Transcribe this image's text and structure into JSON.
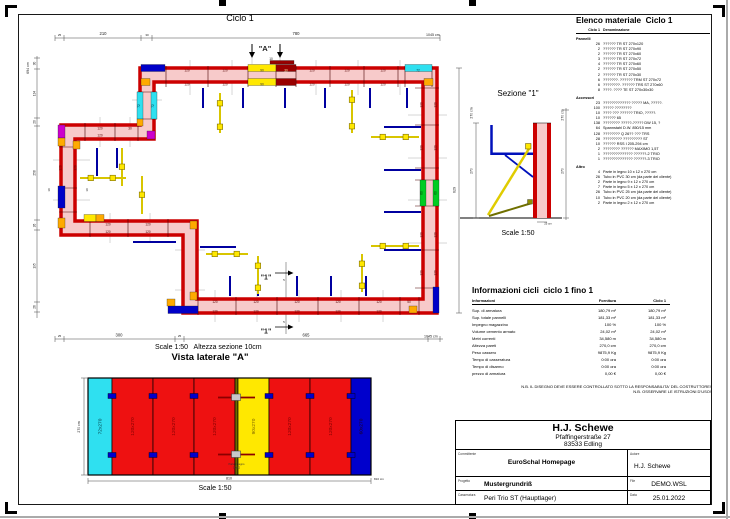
{
  "page": {
    "ciclo_title": "Ciclo 1"
  },
  "plan": {
    "scale_note": "Scale 1:50   Altezza sezione 10cm",
    "labels": [
      {
        "x": 59.5,
        "y": 36,
        "t": "25",
        "s": 3
      },
      {
        "x": 103,
        "y": 35,
        "t": "210"
      },
      {
        "x": 147,
        "y": 36,
        "t": "30",
        "s": 3
      },
      {
        "x": 296,
        "y": 35,
        "t": "780"
      },
      {
        "x": 426,
        "y": 36,
        "t": "1045 cm",
        "s": 3.6,
        "a": "start"
      },
      {
        "x": 29,
        "y": 68,
        "t": "694 cm",
        "r": -90,
        "s": 3.6
      },
      {
        "x": 35.5,
        "y": 63.5,
        "t": "30",
        "r": -90,
        "s": 3.2
      },
      {
        "x": 35.5,
        "y": 93.5,
        "t": "134",
        "r": -90,
        "s": 3.2
      },
      {
        "x": 35.5,
        "y": 122,
        "t": "20",
        "r": -90,
        "s": 3.2
      },
      {
        "x": 35.5,
        "y": 173,
        "t": "258",
        "r": -90,
        "s": 3.2
      },
      {
        "x": 35.5,
        "y": 225.5,
        "t": "26",
        "r": -90,
        "s": 3.2
      },
      {
        "x": 35.5,
        "y": 266,
        "t": "195",
        "r": -90,
        "s": 3.2
      },
      {
        "x": 35.5,
        "y": 307,
        "t": "26",
        "r": -90,
        "s": 3.2
      },
      {
        "x": 59.5,
        "y": 337,
        "t": "25",
        "s": 3
      },
      {
        "x": 119,
        "y": 336.5,
        "t": "300"
      },
      {
        "x": 179.5,
        "y": 337,
        "t": "25",
        "s": 3
      },
      {
        "x": 306,
        "y": 336.5,
        "t": "665"
      },
      {
        "x": 424,
        "y": 337.5,
        "t": "1045 cm",
        "s": 3.6,
        "a": "start"
      },
      {
        "x": 455.5,
        "y": 190,
        "t": "629",
        "r": -90,
        "s": 3.6
      },
      {
        "x": 271,
        "y": 60,
        "t": "10",
        "s": 3.2
      },
      {
        "x": 284,
        "y": 281,
        "t": "5",
        "s": 3
      },
      {
        "x": 284,
        "y": 323,
        "t": "5",
        "s": 3
      },
      {
        "x": 50,
        "y": 190,
        "t": "10",
        "r": -90,
        "s": 3
      },
      {
        "x": 88,
        "y": 190,
        "t": "10",
        "r": -90,
        "s": 3
      },
      {
        "x": 265,
        "y": 51,
        "t": "\"A\"",
        "s": 7.5,
        "b": 1
      },
      {
        "x": 266,
        "y": 279.5,
        "t": "\"1\"",
        "s": 7,
        "b": 1
      },
      {
        "x": 266,
        "y": 333.5,
        "t": "\"1\"",
        "s": 7,
        "b": 1
      },
      {
        "x": 187,
        "y": 71.3,
        "t": "120",
        "s": 3.2,
        "c": "#550000"
      },
      {
        "x": 225,
        "y": 71.3,
        "t": "120",
        "s": 3.2,
        "c": "#550000"
      },
      {
        "x": 262,
        "y": 71.3,
        "t": "90",
        "s": 3.2,
        "c": "#333333"
      },
      {
        "x": 286,
        "y": 71.3,
        "t": "30",
        "s": 3.2,
        "c": "#ffeeaa"
      },
      {
        "x": 312,
        "y": 71.3,
        "t": "120",
        "s": 3.2,
        "c": "#550000"
      },
      {
        "x": 347,
        "y": 71.3,
        "t": "120",
        "s": 3.2,
        "c": "#550000"
      },
      {
        "x": 383,
        "y": 71.3,
        "t": "120",
        "s": 3.2,
        "c": "#550000"
      },
      {
        "x": 418,
        "y": 71.3,
        "t": "72",
        "s": 3.2,
        "c": "#003344"
      },
      {
        "x": 187,
        "y": 85.3,
        "t": "120",
        "s": 3.2,
        "c": "#550000"
      },
      {
        "x": 225,
        "y": 85.3,
        "t": "120",
        "s": 3.2,
        "c": "#550000"
      },
      {
        "x": 262,
        "y": 85.3,
        "t": "90",
        "s": 3.2,
        "c": "#333333"
      },
      {
        "x": 312,
        "y": 85.3,
        "t": "120",
        "s": 3.2,
        "c": "#550000"
      },
      {
        "x": 347,
        "y": 85.3,
        "t": "120",
        "s": 3.2,
        "c": "#550000"
      },
      {
        "x": 383,
        "y": 85.3,
        "t": "120",
        "s": 3.2,
        "c": "#550000"
      },
      {
        "x": 436.5,
        "y": 105,
        "t": "120",
        "r": -90,
        "s": 3.2,
        "c": "#550000"
      },
      {
        "x": 436.5,
        "y": 148,
        "t": "120",
        "r": -90,
        "s": 3.2,
        "c": "#550000"
      },
      {
        "x": 436.5,
        "y": 193,
        "t": "60",
        "r": -90,
        "s": 3.2,
        "c": "#003300"
      },
      {
        "x": 436.5,
        "y": 235,
        "t": "120",
        "r": -90,
        "s": 3.2,
        "c": "#550000"
      },
      {
        "x": 436.5,
        "y": 273,
        "t": "120",
        "r": -90,
        "s": 3.2,
        "c": "#550000"
      },
      {
        "x": 422.5,
        "y": 105,
        "t": "120",
        "r": -90,
        "s": 3.2,
        "c": "#550000"
      },
      {
        "x": 422.5,
        "y": 148,
        "t": "120",
        "r": -90,
        "s": 3.2,
        "c": "#550000"
      },
      {
        "x": 422.5,
        "y": 193,
        "t": "60",
        "r": -90,
        "s": 3.2,
        "c": "#003300"
      },
      {
        "x": 422.5,
        "y": 235,
        "t": "120",
        "r": -90,
        "s": 3.2,
        "c": "#550000"
      },
      {
        "x": 422.5,
        "y": 273,
        "t": "120",
        "r": -90,
        "s": 3.2,
        "c": "#550000"
      },
      {
        "x": 215,
        "y": 302.8,
        "t": "120",
        "s": 3.2,
        "c": "#550000"
      },
      {
        "x": 256,
        "y": 302.8,
        "t": "120",
        "s": 3.2,
        "c": "#550000"
      },
      {
        "x": 297,
        "y": 302.8,
        "t": "120",
        "s": 3.2,
        "c": "#550000"
      },
      {
        "x": 338,
        "y": 302.8,
        "t": "120",
        "s": 3.2,
        "c": "#550000"
      },
      {
        "x": 379,
        "y": 302.8,
        "t": "120",
        "s": 3.2,
        "c": "#550000"
      },
      {
        "x": 409,
        "y": 302.8,
        "t": "50",
        "s": 3.2,
        "c": "#550000"
      },
      {
        "x": 215,
        "y": 312.3,
        "t": "120",
        "s": 3.2,
        "c": "#550000"
      },
      {
        "x": 256,
        "y": 312.3,
        "t": "120",
        "s": 3.2,
        "c": "#550000"
      },
      {
        "x": 297,
        "y": 312.3,
        "t": "120",
        "s": 3.2,
        "c": "#550000"
      },
      {
        "x": 338,
        "y": 312.3,
        "t": "120",
        "s": 3.2,
        "c": "#550000"
      },
      {
        "x": 379,
        "y": 312.3,
        "t": "120",
        "s": 3.2,
        "c": "#550000"
      },
      {
        "x": 108,
        "y": 225.3,
        "t": "120",
        "s": 3.2,
        "c": "#550000"
      },
      {
        "x": 148,
        "y": 225.3,
        "t": "120",
        "s": 3.2,
        "c": "#550000"
      },
      {
        "x": 108,
        "y": 232.8,
        "t": "120",
        "s": 3.2,
        "c": "#550000"
      },
      {
        "x": 148,
        "y": 232.8,
        "t": "120",
        "s": 3.2,
        "c": "#550000"
      },
      {
        "x": 100,
        "y": 129.3,
        "t": "120",
        "s": 3.2,
        "c": "#550000"
      },
      {
        "x": 130,
        "y": 129.3,
        "t": "30",
        "s": 3.2,
        "c": "#550000"
      },
      {
        "x": 100,
        "y": 136.3,
        "t": "120",
        "s": 3.2,
        "c": "#550000"
      },
      {
        "x": 61.5,
        "y": 168,
        "t": "120",
        "r": -90,
        "s": 3.2,
        "c": "#550000"
      },
      {
        "x": 76.5,
        "y": 168,
        "t": "120",
        "r": -90,
        "s": 3.2,
        "c": "#550000"
      },
      {
        "x": 140,
        "y": 106,
        "t": "72",
        "r": -90,
        "s": 3.2,
        "c": "#003344"
      },
      {
        "x": 154,
        "y": 106,
        "t": "72",
        "r": -90,
        "s": 3.2,
        "c": "#003344"
      }
    ]
  },
  "sezione": {
    "title": "Sezione \"1\"",
    "scale": "Scale 1:50",
    "labels": [
      {
        "x": 472.5,
        "y": 113,
        "t": "270 cm",
        "r": -90,
        "s": 3.4
      },
      {
        "x": 472.5,
        "y": 171,
        "t": "270",
        "r": -90,
        "s": 3.4
      },
      {
        "x": 563.5,
        "y": 115,
        "t": "270 cm",
        "r": -90,
        "s": 3.4
      },
      {
        "x": 563.5,
        "y": 171,
        "t": "270",
        "r": -90,
        "s": 3.4
      },
      {
        "x": 548,
        "y": 224.5,
        "t": "25 cm",
        "s": 2.8
      }
    ]
  },
  "vista": {
    "title": "Vista laterale \"A\"",
    "scale": "Scale 1:50",
    "panels": [
      {
        "w": 24,
        "color": "#2FE0F0",
        "label": "72x270",
        "lc": "#00333a"
      },
      {
        "w": 41,
        "color": "#EE1111",
        "label": "120x270",
        "lc": "#7a0000"
      },
      {
        "w": 41,
        "color": "#EE1111",
        "label": "120x270",
        "lc": "#7a0000"
      },
      {
        "w": 41,
        "color": "#EE1111",
        "label": "120x270",
        "lc": "#7a0000"
      },
      {
        "w": 3,
        "color": "#6B6B00",
        "label": "",
        "lc": ""
      },
      {
        "w": 31,
        "color": "#FFE800",
        "label": "90x270",
        "lc": "#7a6000"
      },
      {
        "w": 41,
        "color": "#EE1111",
        "label": "120x270",
        "lc": "#7a0000"
      },
      {
        "w": 41,
        "color": "#EE1111",
        "label": "120x270",
        "lc": "#7a0000"
      },
      {
        "w": 20,
        "color": "#0000CC",
        "label": "60x270",
        "lc": "#220011"
      }
    ],
    "labels": [
      {
        "x": 80,
        "y": 427,
        "t": "270 cm",
        "r": -90,
        "s": 3.4
      },
      {
        "x": 229,
        "y": 479.5,
        "t": "810",
        "s": 3.6
      },
      {
        "x": 374,
        "y": 480,
        "t": "810 cm",
        "s": 3,
        "a": "start"
      },
      {
        "x": 236.5,
        "y": 465,
        "t": "Parte in legno",
        "s": 2.6,
        "c": "#333333"
      },
      {
        "x": 236.5,
        "y": 468.5,
        "t": "10x12",
        "s": 2.6,
        "c": "#333333"
      }
    ]
  },
  "material_list": {
    "title": "Elenco materiale  Ciclo 1",
    "col_qty": "Ciclo 1",
    "col_name": "Denominazione",
    "groups": [
      {
        "name": "Pannelli",
        "items": [
          [
            "26",
            "?????? TR ST 270x120"
          ],
          [
            "2",
            "?????? TR ST 270x90"
          ],
          [
            "2",
            "?????? TR ST 270x60"
          ],
          [
            "3",
            "?????? TR ST 270x72"
          ],
          [
            "4",
            "?????? TR ST 270x60"
          ],
          [
            "2",
            "?????? TR ST 270x50"
          ],
          [
            "2",
            "?????? TR ST 270x30"
          ],
          [
            "6",
            "???????. ?????? TRM ST 270x72"
          ],
          [
            "6",
            "????????. ?????? TRS ST 270x60"
          ],
          [
            "8",
            "????. ???? TE ST 270x30x30"
          ]
        ]
      },
      {
        "name": "Accessori",
        "items": [
          [
            "23",
            "????????????? ????? MA, ?????."
          ],
          [
            "100",
            "????? ????????"
          ],
          [
            "10",
            "???? ??? ?????? TRIO, ?????."
          ],
          [
            "10",
            "?????? 65"
          ],
          [
            "138",
            "???????? ?????-????? DW 15, ?"
          ],
          [
            "64",
            "Spannstahl  D.W. 850/15 mm"
          ],
          [
            "128",
            "???????? Q 26?? ??? TRS"
          ],
          [
            "28",
            "????????? ????????? ST"
          ],
          [
            "10",
            "?????? RSS I  205-294 cm"
          ],
          [
            "2",
            "???????? ?????? MAXIMO 1,5T"
          ],
          [
            "1",
            "?????????????? ??????-2 TRIO"
          ],
          [
            "1",
            "?????????????? ??????-3 TRIO"
          ]
        ]
      },
      {
        "name": "Altro",
        "items": [
          [
            "4",
            "Parte in legno 10 x 12 x 270 cm"
          ],
          [
            "26",
            "Tubo in PVC 30 cm (da parte del cliente)"
          ],
          [
            "2",
            "Parte in legno 9 x 12 x 270 cm"
          ],
          [
            "7",
            "Parte in legno 5 x 12 x 270 cm"
          ],
          [
            "26",
            "Tubo in PVC 25 cm (da parte del cliente)"
          ],
          [
            "10",
            "Tubo in PVC 20 cm (da parte del cliente)"
          ],
          [
            "2",
            "Parte in legno 2 x 12 x 270 cm"
          ]
        ]
      }
    ]
  },
  "info_table": {
    "title": "Informazioni cicli  ciclo 1 fino 1",
    "col_info": "Informazioni",
    "col_fornitura": "Fornitura",
    "col_ciclo": "Ciclo 1",
    "rows": [
      [
        "Sup. di armatura",
        "180,79 m²",
        "180,79 m²"
      ],
      [
        "Sup. totale pannelli",
        "181,33 m²",
        "181,33 m²"
      ],
      [
        "Impegno magazzino",
        "100 %",
        "100 %"
      ],
      [
        "Volume cemento armato",
        "24,02 m³",
        "24,02 m³"
      ],
      [
        "Metri correnti",
        "34,580 m",
        "34,580 m"
      ],
      [
        "Altezza pareti",
        "270,0 cm",
        "270,0 cm"
      ],
      [
        "Peso cassero",
        "9875,9 Kg",
        "9875,9 Kg"
      ],
      [
        "Tempo di casseratura",
        "0:00 ora",
        "0:00 ora"
      ],
      [
        "Tempo di disarmo",
        "0:00 ora",
        "0:00 ora"
      ],
      [
        "prezzo di armatura",
        "0,00 €",
        "0,00 €"
      ]
    ]
  },
  "notes": {
    "nb1": "N.B. IL DISEGNO DEVE ESSERE CONTROLLATO SOTTO LA RESPONSABILITA' DEL COSTRUTTORE!",
    "nb2": "N.B. OSSERVARE LE ISTRUZIONI D'USO!"
  },
  "title_block": {
    "company": "H.J. Schewe",
    "street": "Pfaffingerstraße 27",
    "city": "83533 Edling",
    "committente_label": "Committente",
    "committente": "EuroSchal Homepage",
    "autore_label": "Autore",
    "autore": "H.J. Schewe",
    "progetto_label": "Progetto",
    "progetto": "Mustergrundriß",
    "file_label": "File",
    "file": "DEMO.WSL",
    "casseratura_label": "Casseratura",
    "casseratura": "Peri Trio ST (Hauptlager)",
    "data_label": "Data",
    "data": "25.01.2022"
  },
  "colors": {
    "panel_red": "#CC0000",
    "wall_pink": "#F7CACA",
    "panel_cyan": "#2FE0F0",
    "panel_yellow": "#FFE800",
    "panel_green": "#00CC22",
    "panel_blue": "#0000C8",
    "panel_magenta": "#CC00CC",
    "panel_orange": "#FFAA00"
  }
}
